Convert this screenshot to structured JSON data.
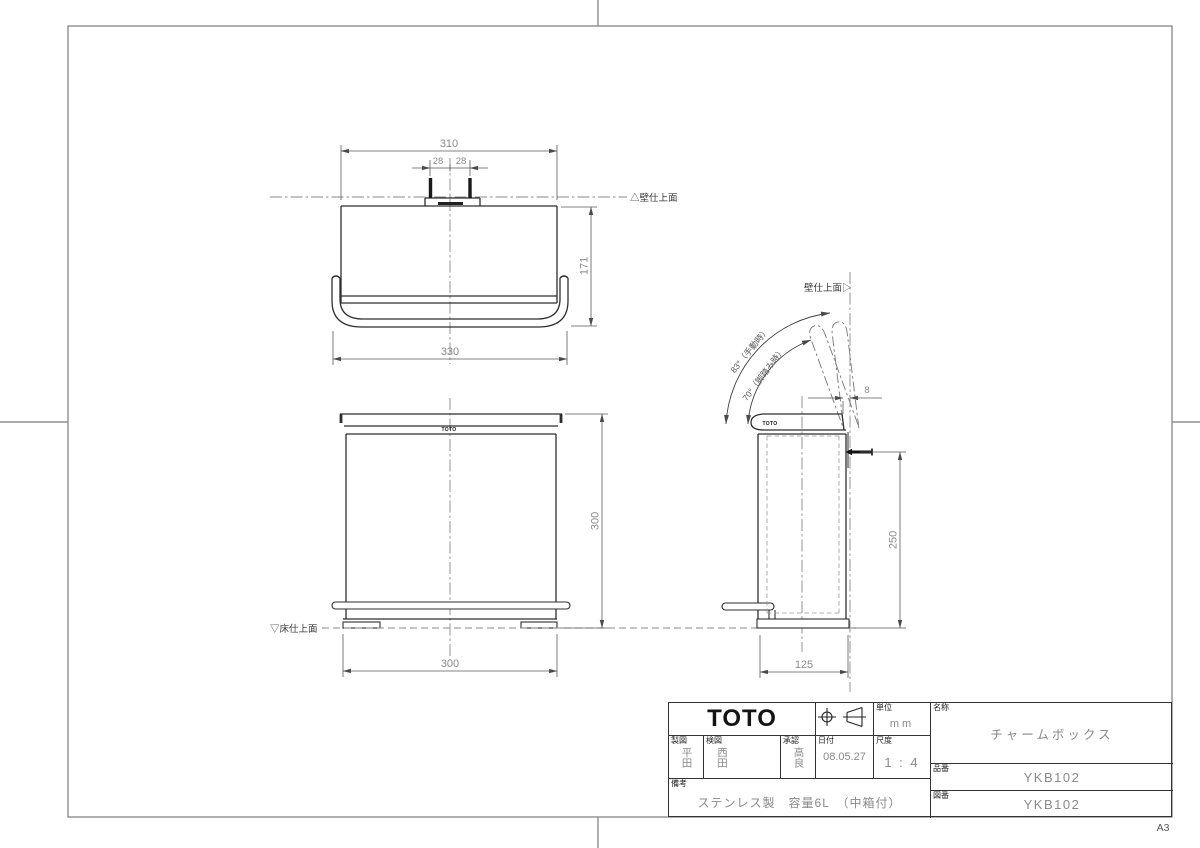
{
  "sheet": {
    "size_label": "A3"
  },
  "views": {
    "top": {
      "dim_width_body": "310",
      "dim_tab_left": "28",
      "dim_tab_right": "28",
      "dim_depth": "171",
      "dim_width_handle": "330",
      "wall_label": "△壁仕上面"
    },
    "front": {
      "logo": "TOTO",
      "dim_height": "300",
      "dim_width": "300",
      "floor_label": "▽床仕上面"
    },
    "side": {
      "logo": "TOTO",
      "wall_label": "壁仕上面▷",
      "angle_manual": "83°（手動時）",
      "angle_pedal": "70°（脚踏み時）",
      "dim_wall_gap": "8",
      "dim_mount_height": "250",
      "dim_depth": "125"
    }
  },
  "title_block": {
    "logo": "TOTO",
    "unit": {
      "label": "単位",
      "value": "mm"
    },
    "drafter": {
      "label": "製図",
      "value": "平田"
    },
    "checker": {
      "label": "検図",
      "value": "西田"
    },
    "approver": {
      "label": "承認",
      "value": "高良"
    },
    "date": {
      "label": "日付",
      "value": "08.05.27"
    },
    "scale": {
      "label": "尺度",
      "value": "1 : 4"
    },
    "remarks": {
      "label": "備考",
      "value": "ステンレス製　容量6L　（中箱付）"
    },
    "name": {
      "label": "名称",
      "value": "チャームボックス"
    },
    "product_no": {
      "label": "品番",
      "value": "YKB102"
    },
    "drawing_no": {
      "label": "図番",
      "value": "YKB102"
    }
  }
}
